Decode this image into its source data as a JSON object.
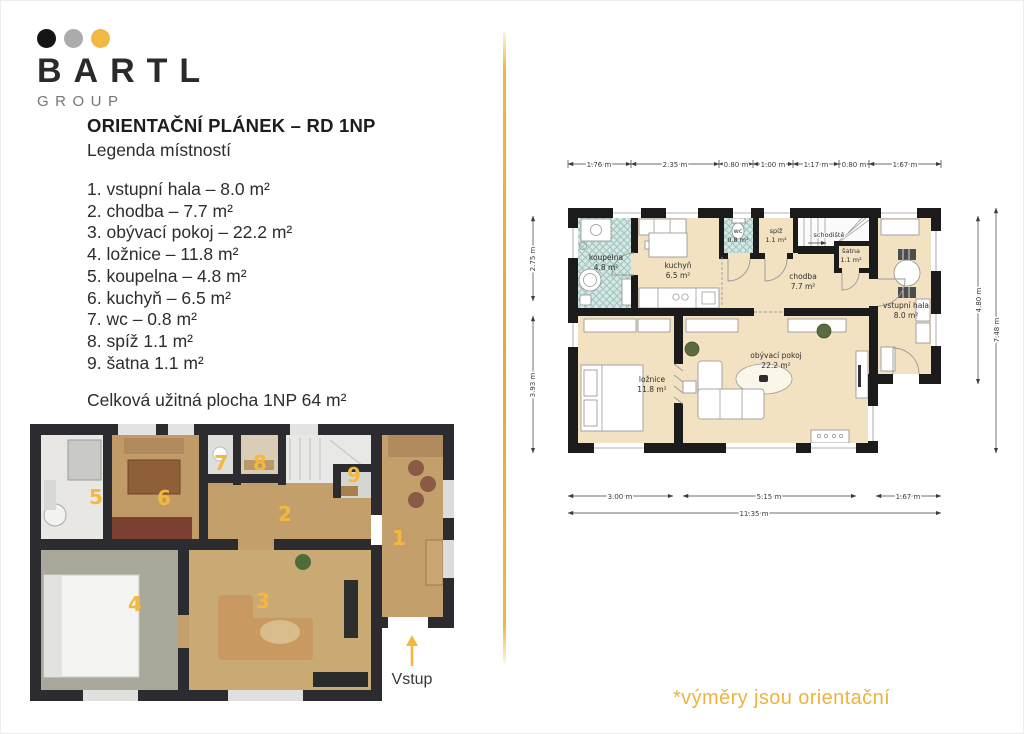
{
  "brand": {
    "name": "BARTL",
    "subtitle": "GROUP",
    "dot_colors": [
      "#141414",
      "#ababab",
      "#f2b844"
    ]
  },
  "header": {
    "title": "ORIENTAČNÍ PLÁNEK – RD 1NP",
    "subtitle": "Legenda místností"
  },
  "legend": {
    "items": [
      "1. vstupní hala – 8.0 m²",
      "2. chodba – 7.7 m²",
      "3. obývací pokoj – 22.2 m²",
      "4. ložnice – 11.8 m²",
      "5. koupelna – 4.8 m²",
      "6. kuchyň – 6.5 m²",
      "7. wc – 0.8 m²",
      "8. spíž 1.1 m²",
      "9. šatna 1.1 m²"
    ],
    "total": "Celková užitná plocha 1NP 64 m²"
  },
  "plan3d": {
    "numbers": {
      "n1": "1",
      "n2": "2",
      "n3": "3",
      "n4": "4",
      "n5": "5",
      "n6": "6",
      "n7": "7",
      "n8": "8",
      "n9": "9"
    },
    "entry_label": "Vstup"
  },
  "plan2d": {
    "rooms": {
      "koupelna": {
        "name": "koupelna",
        "area": "4.8 m²"
      },
      "kuchyn": {
        "name": "kuchyň",
        "area": "6.5 m²"
      },
      "wc": {
        "name": "wc",
        "area": "0.8 m²"
      },
      "spiz": {
        "name": "spíž",
        "area": "1.1 m²"
      },
      "schodiste": {
        "name": "schodiště"
      },
      "satna": {
        "name": "šatna",
        "area": "1.1 m²"
      },
      "chodba": {
        "name": "chodba",
        "area": "7.7 m²"
      },
      "hala": {
        "name": "vstupní hala",
        "area": "8.0 m²"
      },
      "loznice": {
        "name": "ložnice",
        "area": "11.8 m²"
      },
      "obyvaci": {
        "name": "obývací pokoj",
        "area": "22.2 m²"
      }
    },
    "dims_top": [
      "1.76 m",
      "2.35 m",
      "0.80 m",
      "1.00 m",
      "1.17 m",
      "0.80 m",
      "1.67 m"
    ],
    "dims_bottom": [
      "3.00 m",
      "5.15 m",
      "1.67 m"
    ],
    "dim_total": "11.35 m",
    "dims_left": [
      "2.75 m",
      "3.93 m"
    ],
    "dims_right": [
      "4.80 m",
      "7.48 m"
    ]
  },
  "footnote": "*výměry jsou orientační",
  "colors": {
    "accent": "#eeb43c",
    "wall": "#1b1b1b",
    "floor_beige": "#f2e2c2",
    "tile_teal": "#cfe4e1"
  }
}
